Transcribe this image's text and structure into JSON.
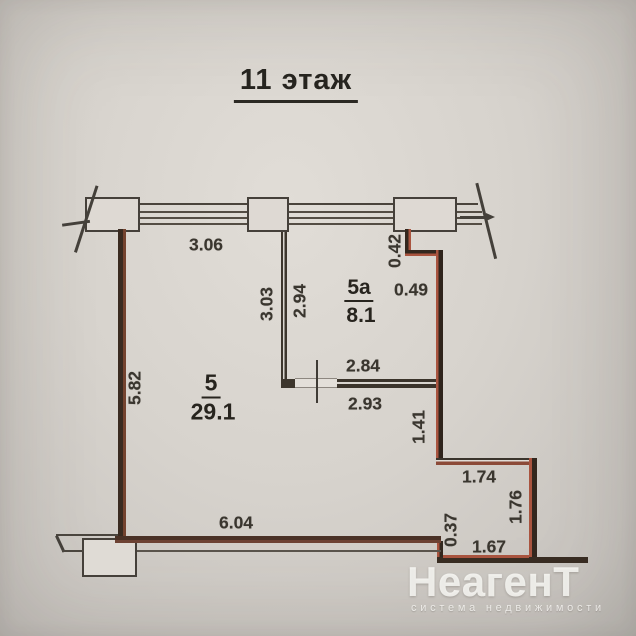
{
  "plan": {
    "floor_label": "11 этаж",
    "rooms": [
      {
        "number": "5",
        "area": "29.1"
      },
      {
        "number": "5а",
        "area": "8.1"
      }
    ],
    "dims": {
      "top_wall": "3.06",
      "left_wall": "5.82",
      "bottom_wall": "6.04",
      "partition_room5_side": "3.03",
      "partition_room5a_side": "2.94",
      "top_step_vertical": "0.42",
      "top_step_horizontal": "0.49",
      "room5a_bottom_inner": "2.84",
      "room5a_bottom_outer": "2.93",
      "right_wall_lower": "1.41",
      "right_step_horizontal": "1.74",
      "right_step_vertical": "1.76",
      "bottom_step_vertical": "0.37",
      "bottom_step_horizontal": "1.67"
    }
  },
  "watermark": {
    "brand": "НеагенТ",
    "tagline": "система недвижимости"
  },
  "colors": {
    "paper": "#d7d3cd",
    "wall_dark": "#33271e",
    "boundary_red": "#a9543f",
    "text": "#3a362f",
    "watermark_white": "#fdfcf9"
  }
}
